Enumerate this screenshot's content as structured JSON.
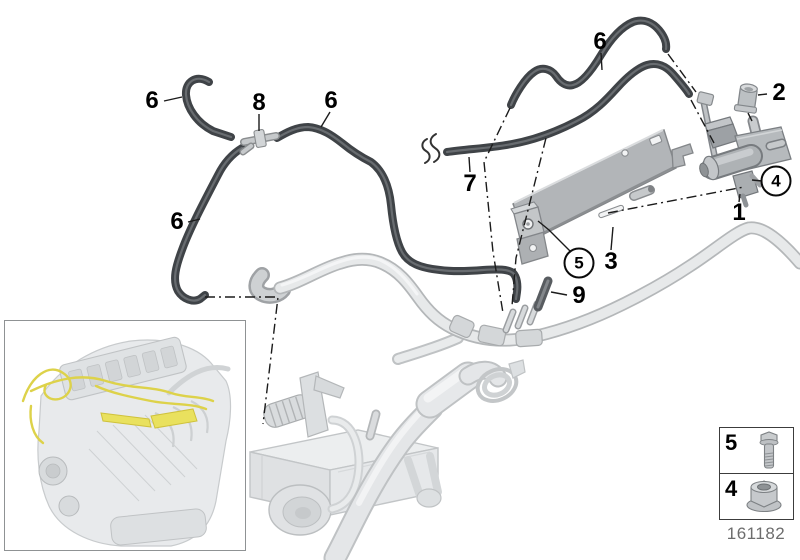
{
  "figure": {
    "background": "#ffffff",
    "doc_number": "161182",
    "callouts": [
      {
        "id": "hose-top-left",
        "label": "6",
        "style": "plain"
      },
      {
        "id": "t-connector",
        "label": "8",
        "style": "plain"
      },
      {
        "id": "hose-top-mid",
        "label": "6",
        "style": "plain"
      },
      {
        "id": "hose-top-right",
        "label": "6",
        "style": "plain"
      },
      {
        "id": "hose-left-long",
        "label": "6",
        "style": "plain"
      },
      {
        "id": "sealing-cap",
        "label": "2",
        "style": "plain"
      },
      {
        "id": "hose-cut-off",
        "label": "7",
        "style": "plain"
      },
      {
        "id": "pressure-converter",
        "label": "1",
        "style": "plain"
      },
      {
        "id": "bracket",
        "label": "3",
        "style": "plain"
      },
      {
        "id": "hose-piece",
        "label": "9",
        "style": "plain"
      },
      {
        "id": "screw",
        "label": "5",
        "style": "circled"
      },
      {
        "id": "nut",
        "label": "4",
        "style": "circled"
      }
    ],
    "legend": {
      "rows": [
        {
          "label": "5",
          "icon": "hex-bolt-icon"
        },
        {
          "label": "4",
          "icon": "flange-nut-icon"
        }
      ]
    },
    "colors": {
      "hose_dark": "#3f4347",
      "metal_gray": "#b2b5b8",
      "pipe_light": "#e7e9ea",
      "harness_yellow": "#ddd24a"
    }
  }
}
